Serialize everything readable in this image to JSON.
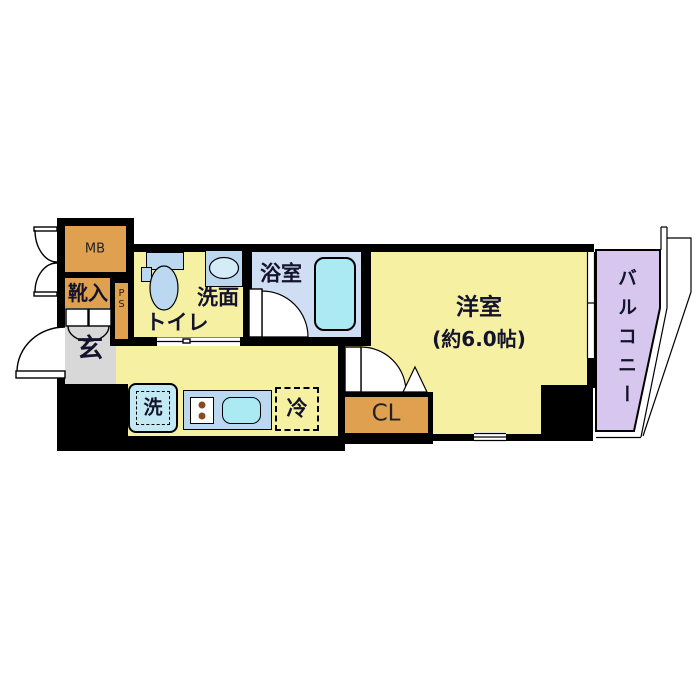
{
  "rooms": {
    "mb": "MB",
    "shoe_cabinet": "靴入",
    "pipe_space": "PS",
    "toilet": "トイレ",
    "washroom": "洗面",
    "bathroom": "浴室",
    "entrance": "玄",
    "western_room": "洋室",
    "western_room_size": "(約6.0帖)",
    "balcony": "バルコニー",
    "closet": "CL",
    "washer": "洗",
    "fridge": "冷"
  },
  "colors": {
    "wall": "#000000",
    "room_yellow": "#f6f0a3",
    "cabinet_orange": "#dfa050",
    "entrance_gray": "#d8d8d8",
    "bath_floor": "#cfdef2",
    "fixture_blue": "#bcd7f0",
    "tub_cyan": "#abe9f3",
    "balcony_lavender": "#d7c7ee"
  }
}
